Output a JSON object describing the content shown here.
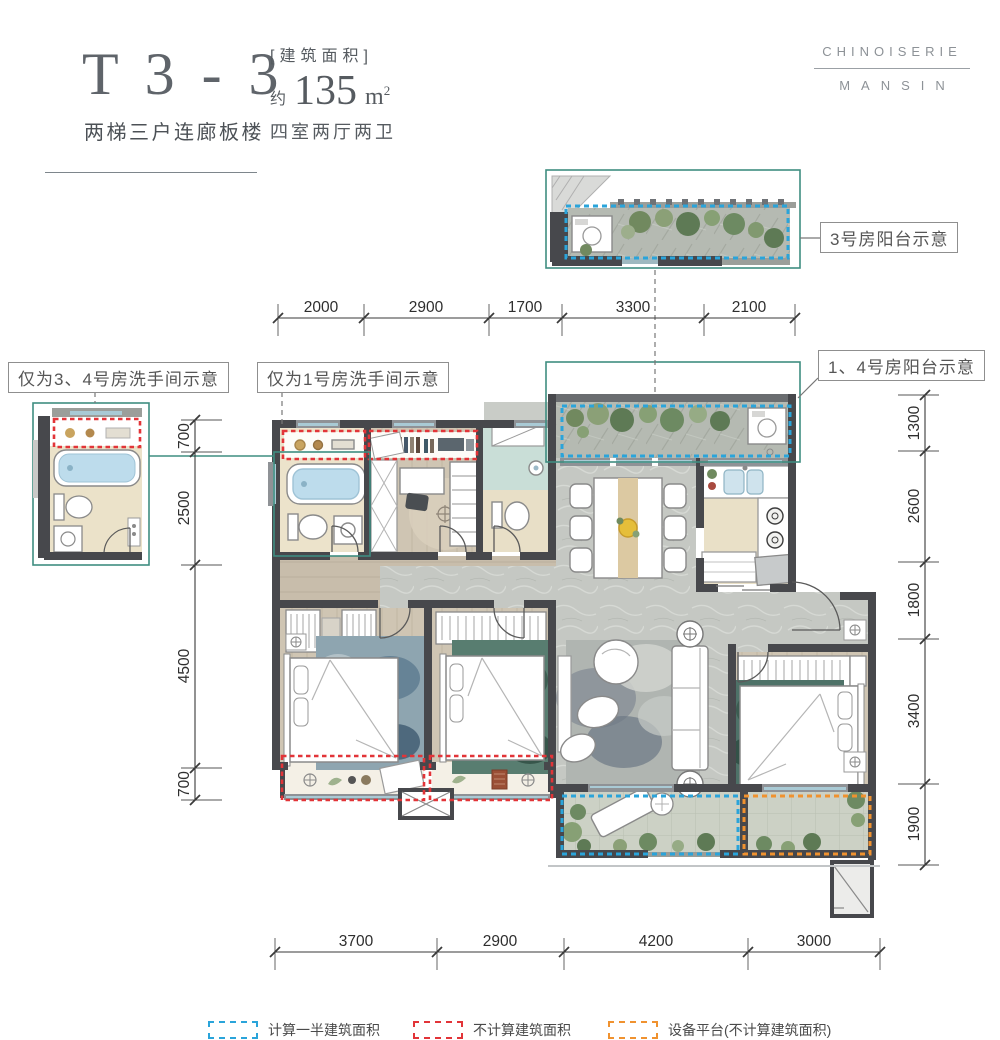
{
  "header": {
    "model": "T 3 - 3",
    "model_subtitle": "两梯三户连廊板楼",
    "area_label": "[建筑面积]",
    "area_prefix": "约",
    "area_value": "135",
    "area_unit": "m",
    "area_unit_sup": "2",
    "rooms": "四室两厅两卫"
  },
  "logo": {
    "line1": "CHINOISERIE",
    "line2": "MANSIN"
  },
  "callouts": {
    "balcony_room3": "3号房阳台示意",
    "balcony_room14": "1、4号房阳台示意",
    "bath_room34": "仅为3、4号房洗手间示意",
    "bath_room1": "仅为1号房洗手间示意"
  },
  "dimensions": {
    "top": [
      "2000",
      "2900",
      "1700",
      "3300",
      "2100"
    ],
    "bottom": [
      "3700",
      "2900",
      "4200",
      "3000"
    ],
    "left": [
      "700",
      "2500",
      "4500",
      "700"
    ],
    "right": [
      "1300",
      "2600",
      "1800",
      "3400",
      "1900"
    ]
  },
  "legend": [
    {
      "label": "计算一半建筑面积",
      "color": "#2aa4da"
    },
    {
      "label": "不计算建筑面积",
      "color": "#e23438"
    },
    {
      "label": "设备平台(不计算建筑面积)",
      "color": "#f0922f"
    }
  ],
  "colors": {
    "half_area_blue": "#2aa4da",
    "excluded_red": "#e23438",
    "equipment_orange": "#f0922f",
    "detail_outline_teal": "#3f8d80",
    "wall": "#47484c"
  }
}
